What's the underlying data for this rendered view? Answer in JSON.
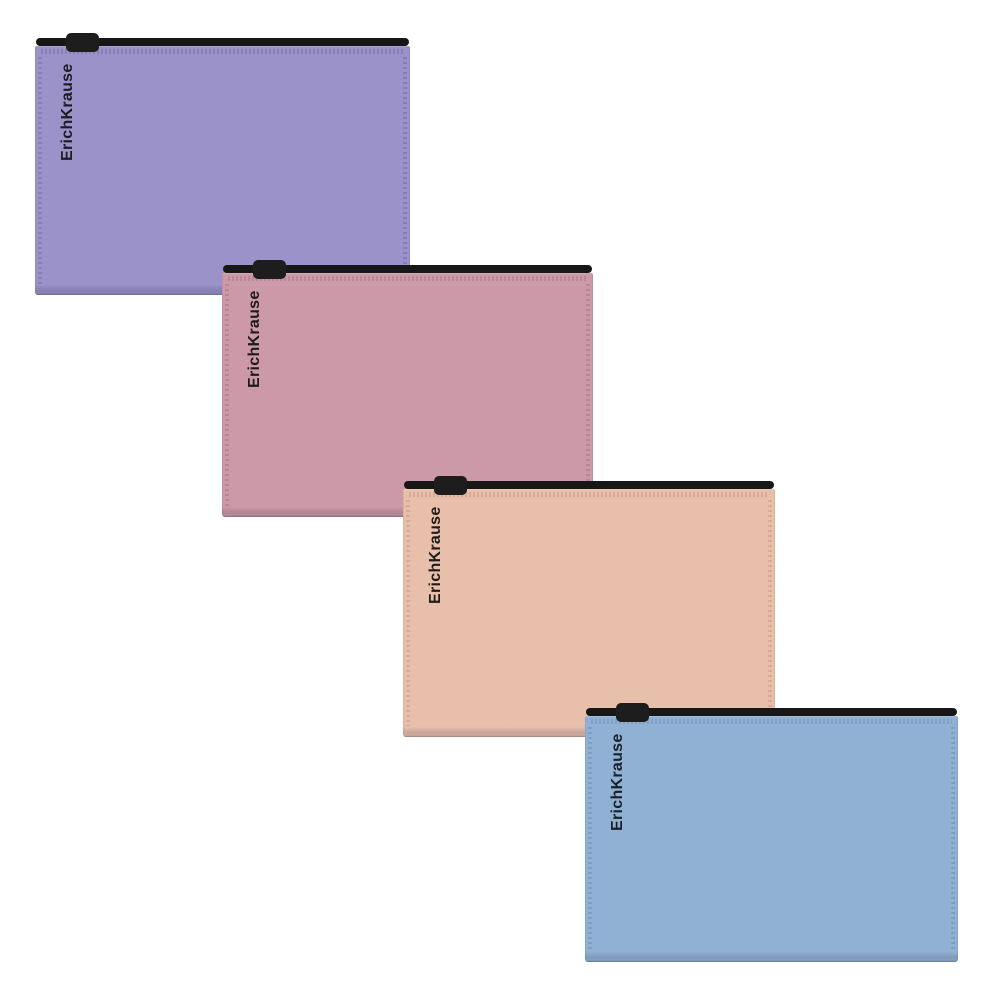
{
  "gallery": {
    "brand": "ErichKrause",
    "product_type": "zip pouch with black zipper",
    "background_color": "#ffffff",
    "items": [
      {
        "id": "lavender",
        "brand_label": "ErichKrause",
        "color_name": "lavender",
        "body_color": "#9a92c8",
        "stitch_color": "#8278b3",
        "zipper_color": "#171717",
        "pull_color": "#1d1d1d",
        "text_color": "#1c1c24"
      },
      {
        "id": "rose",
        "brand_label": "ErichKrause",
        "color_name": "dusty rose",
        "body_color": "#cb99a7",
        "stitch_color": "#b48192",
        "zipper_color": "#171717",
        "pull_color": "#1d1d1d",
        "text_color": "#1f1a1d"
      },
      {
        "id": "peach",
        "brand_label": "ErichKrause",
        "color_name": "peach beige",
        "body_color": "#e8bfab",
        "stitch_color": "#d6a48c",
        "zipper_color": "#171717",
        "pull_color": "#1d1d1d",
        "text_color": "#201b19"
      },
      {
        "id": "blue",
        "brand_label": "ErichKrause",
        "color_name": "powder blue",
        "body_color": "#90b1d3",
        "stitch_color": "#7a9cc0",
        "zipper_color": "#171717",
        "pull_color": "#1d1d1d",
        "text_color": "#18202a"
      }
    ]
  }
}
